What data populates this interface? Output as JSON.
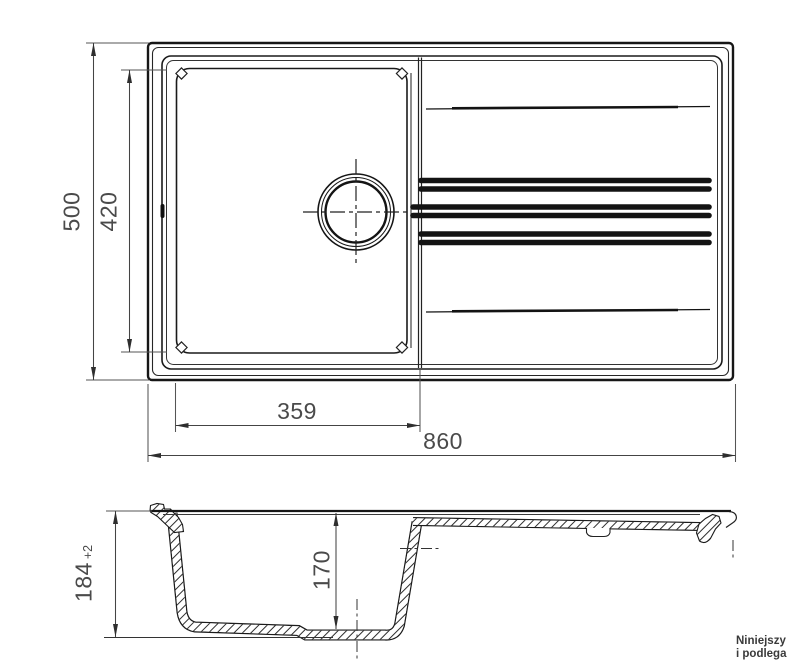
{
  "drawing": {
    "type": "sink-technical-drawing",
    "views": [
      "top-view",
      "section-view"
    ]
  },
  "dims": {
    "depth": "500",
    "bowl_inner_depth": "420",
    "bowl_inner_width": "359",
    "overall_width": "860",
    "section_height": "184",
    "section_height_tol": "+2",
    "section_bowl_depth": "170"
  },
  "note": {
    "line1": "Niniejszy",
    "line2": "i podlega"
  },
  "colors": {
    "outline": "#161616",
    "dim_line": "#444444",
    "dim_text": "#4a4a4a",
    "note_text": "#3a3a3a",
    "background": "#ffffff"
  }
}
